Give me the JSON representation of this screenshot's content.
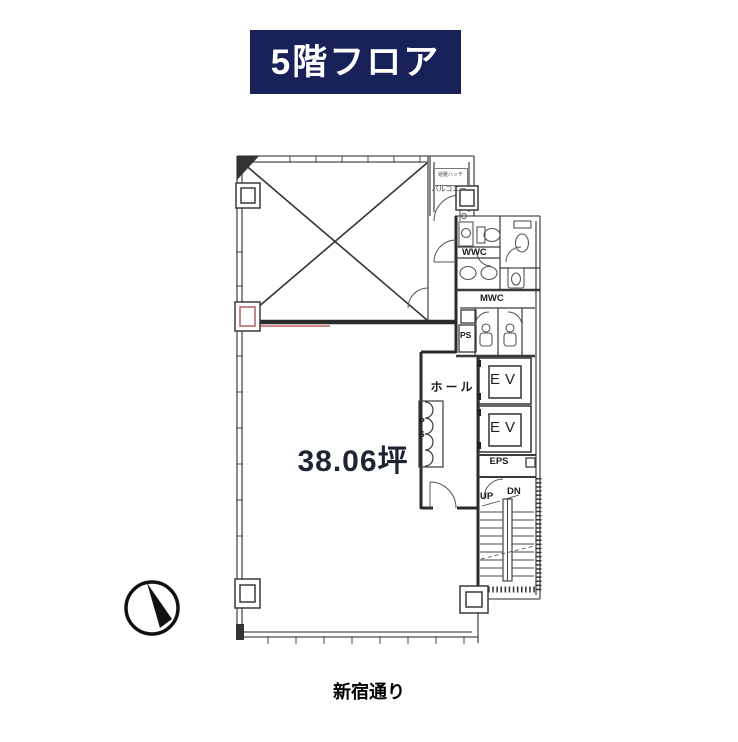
{
  "title": {
    "label": "5階フロア"
  },
  "plan": {
    "area_label": "38.06坪",
    "labels": {
      "balcony": "バルコニー",
      "balcony_hatch": "避難ハッチ",
      "wwc": "WWC",
      "mwc": "MWC",
      "ps_small": "PS",
      "ps_shaft": "PS",
      "hall": "ホール",
      "ev": "EV",
      "eps": "EPS",
      "up": "UP",
      "dn": "DN"
    }
  },
  "street": {
    "label": "新宿通り"
  },
  "icons": {
    "compass": "north-compass-icon"
  },
  "colors": {
    "header_bg": "#192258",
    "header_text": "#ffffff",
    "plan_line": "#4d4d4d",
    "wall_dark": "#2b2b2b",
    "accent_red": "#c15b5b",
    "area_text": "#1d2433"
  }
}
